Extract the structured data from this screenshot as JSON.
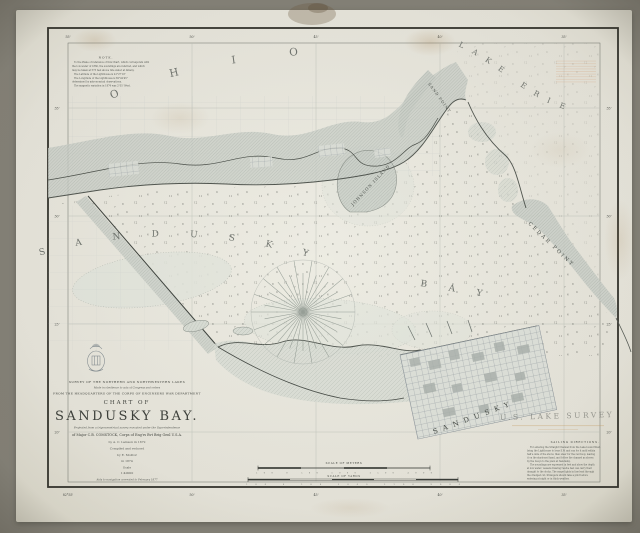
{
  "labels": {
    "state": "OHIO",
    "lake": "LAKE ERIE",
    "bay_word1": "SANDUSKY",
    "bay_word2": "BAY",
    "sand_point": "SAND POINT",
    "cedar_point": "CEDAR POINT",
    "johnson_island": "JOHNSON ISLAND",
    "city": "SANDUSKY"
  },
  "title_block": {
    "l1": "SURVEY OF THE NORTHERN AND NORTHWESTERN LAKES",
    "l2": "Made in obedience to acts of Congress and orders",
    "l3": "FROM THE HEADQUARTERS OF THE CORPS OF ENGINEERS WAR DEPARTMENT",
    "chart_of": "CHART OF",
    "title": "SANDUSKY BAY.",
    "sub1": "Projected from a trigonometrical survey executed under the Superintendence",
    "sub2": "of Major C.B. COMSTOCK, Corps of Eng'rs Bvt Brig Genl U.S.A.",
    "sub3": "by A. C. Lamson in 1872",
    "sub4": "Compiled and reduced",
    "sub5": "by E. Molitor",
    "sub6": "in 1874",
    "scale_word": "Scale",
    "scale_value": "1:40000",
    "aids_note": "Aids to navigation corrected to February 1877"
  },
  "note": {
    "heading": "NOTE.",
    "lines": [
      "To the Plane of reference of this Chart, which corresponds with",
      "the low water of 1860, the soundings are referred, and which",
      "may be taken at 573 feet above tide water at Albany.",
      "The Latitude of the Lighthouse is 41°27'10\"",
      "The Longitude of the Lighthouse is 82°42'45\"",
      "determined by astronomical observations.",
      "The magnetic variation in 1874 was 2°35' West."
    ]
  },
  "sailing": {
    "heading": "SAILING DIRECTIONS.",
    "lines": [
      "For entering the Straight Channel from the Lake bound West,",
      "bring the Lighthouse to bear S.W. and run for it until within",
      "half a mile of the shore; then steer for the red buoy, leaving",
      "it on the starboard hand, and follow the channel as shown",
      "by the buoys to the piers at Sandusky.",
      "The soundings are expressed in feet and show the depth",
      "at low water; vessels drawing twelve feet can carry their",
      "draught to the docks. The range lights in line lead through",
      "the dredged cut. Strangers should take a pilot before",
      "entering at night or in thick weather."
    ]
  },
  "scales": {
    "meters_label": "SCALE OF METERS",
    "meters_ticks": "500    0    500    1000    1500    2000",
    "yards_label": "SCALE OF YARDS",
    "yards_ticks": "500    0    500    1000    1500    2000"
  },
  "border": {
    "top": [
      "55'",
      "50'",
      "45'",
      "40'",
      "35'"
    ],
    "bottom": [
      "82°55'",
      "50'",
      "45'",
      "40'",
      "35'"
    ],
    "left": [
      "35'",
      "30'",
      "25'",
      "20'"
    ],
    "right": [
      "35'",
      "30'",
      "25'",
      "20'"
    ]
  },
  "stamp": {
    "line1": "U.S. LAKE SURVEY"
  },
  "colors": {
    "paper": "#eceae1",
    "ink": "#4c4f4a",
    "land": "#ccd1ca",
    "stamp": "#c89a5e",
    "photo_bg": "#8d8a80"
  }
}
